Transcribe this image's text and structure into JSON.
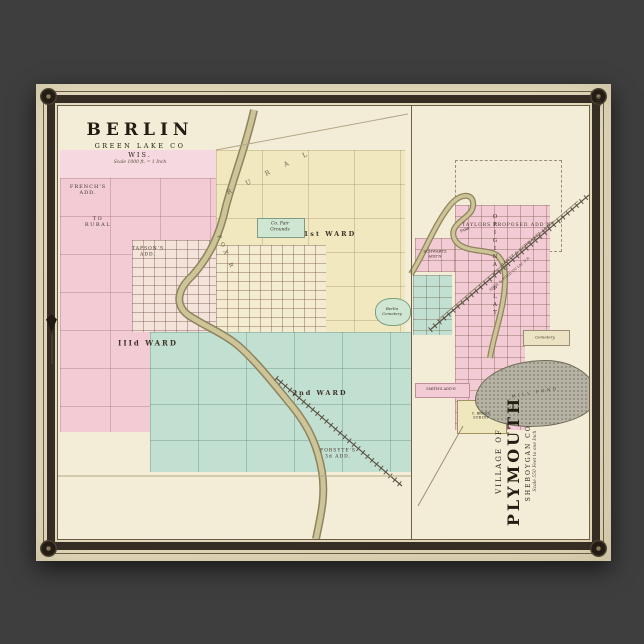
{
  "poster": {
    "page_number": "190",
    "colors": {
      "backdrop": "#3e3e3e",
      "paper": "#ece4c9",
      "map_paper": "#f3edd8",
      "frame": "#362d24",
      "ward_pink": "#f2cbd5",
      "ward_yellow": "#f1e8c0",
      "ward_teal": "#c2e0d2",
      "park_green": "#cfe6d2",
      "river_olive": "#cdc498",
      "pond_gray": "#b7b3a4"
    }
  },
  "berlin_map": {
    "title": "BERLIN",
    "county": "GREEN LAKE CO",
    "state": "WIS.",
    "scale": "Scale 1000 ft. = 1 Inch",
    "labels": {
      "frenchs_add_line1": "FRENCH'S",
      "frenchs_add_line2": "ADD.",
      "to_rural_line1": "TO",
      "to_rural_line2": "RURAL",
      "rural_road": "R U R A L",
      "tapsons_line1": "TAPSON'S",
      "tapsons_line2": "ADD.",
      "fair_grounds_line1": "Co. Fair",
      "fair_grounds_line2": "Grounds",
      "ward_first": "1st WARD",
      "ward_second": "2nd WARD",
      "ward_third": "IIId WARD",
      "cemetery_line1": "Berlin",
      "cemetery_line2": "Cemetery",
      "forsytes_line1": "FORSYTE'S",
      "forsytes_line2": "3d ADD.",
      "fox_river": "FOX R."
    }
  },
  "plymouth_map": {
    "rotated_title": {
      "prefix": "VILLAGE OF",
      "name": "PLYMOUTH",
      "county": "SHEBOYGAN CO.",
      "scale": "Scale 550 Feet to one Inch"
    },
    "labels": {
      "taylors_addn": "TAYLORS PROPOSED ADD'N.",
      "park": "PARK",
      "schwartz_line1": "SCHWARTZ",
      "schwartz_line2": "ADD'N",
      "original_plat": "ORIGINAL PLAT",
      "gantz_schwartz": "GANTZ & SCHWARTZ ADD'N",
      "railroad": "SHEB. & FOND DU LAC R.R.",
      "mill_pond": "MILL POND",
      "cemetery": "Cemetery",
      "smiths_addn": "SMITH'S ADD'N",
      "brand_line1": "C. BRAND",
      "brand_line2": "SUB DIV"
    }
  }
}
